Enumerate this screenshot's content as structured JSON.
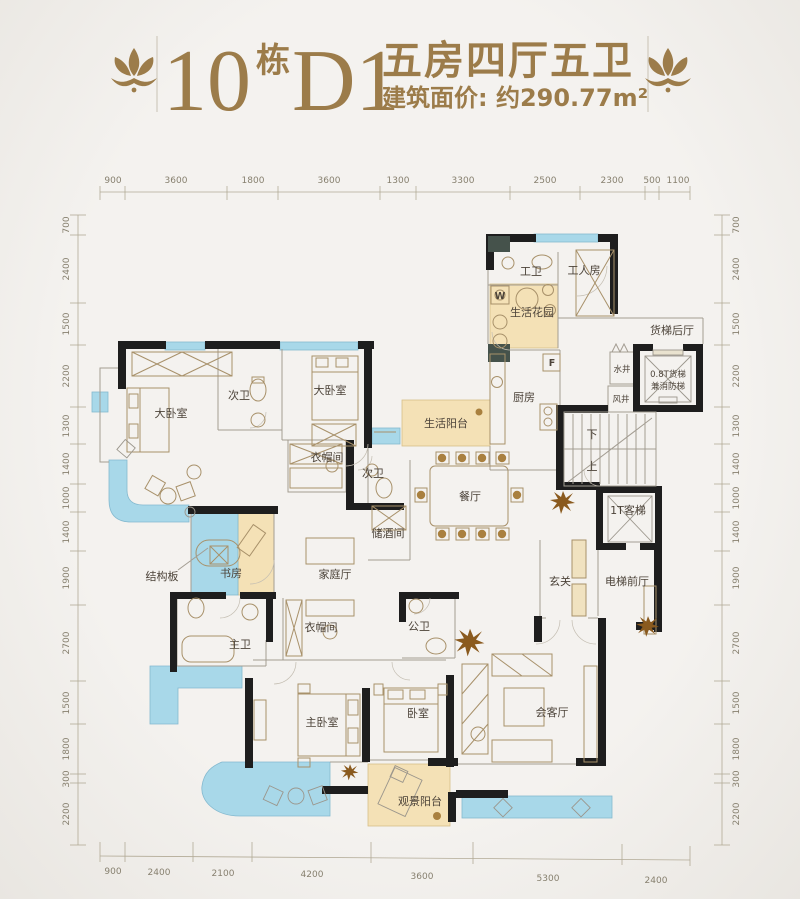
{
  "title": {
    "number": "10",
    "building_suffix": "栋",
    "model": "D1",
    "layout": "五房四厅五卫",
    "area_label": "建筑面价: 约290.77m²"
  },
  "dims": {
    "top": [
      "900",
      "3600",
      "1800",
      "3600",
      "1300",
      "3300",
      "2500",
      "2300",
      "500",
      "1100"
    ],
    "bottom": [
      "900",
      "2400",
      "2100",
      "4200",
      "3600",
      "5300",
      "2400"
    ],
    "left": [
      "700",
      "2400",
      "1500",
      "2200",
      "1300",
      "1400",
      "1000",
      "1400",
      "1900",
      "2700",
      "1500",
      "1800",
      "300",
      "2200"
    ],
    "right": [
      "700",
      "2400",
      "1500",
      "2200",
      "1300",
      "1400",
      "1000",
      "1400",
      "1900",
      "2700",
      "1500",
      "1800",
      "300",
      "2200"
    ]
  },
  "rooms": {
    "gong_wei": "工卫",
    "gongrenfang": "工人房",
    "shenghuo_huayuan": "生活花园",
    "huoti_houting": "货梯后厅",
    "shuijing": "水井",
    "fengjing": "风井",
    "huoti_line1": "0.8T货梯",
    "huoti_line2": "兼消防梯",
    "chufang": "厨房",
    "shenghuo_yangtai": "生活阳台",
    "xia": "下",
    "shang": "上",
    "keti": "1T客梯",
    "dianti_qianting": "电梯前厅",
    "xuanguan": "玄关",
    "canting": "餐厅",
    "chujiujian": "储酒间",
    "jiating_ting": "家庭厅",
    "da_woshi_1": "大卧室",
    "ci_wei_1": "次卫",
    "da_woshi_2": "大卧室",
    "yimaojian_1": "衣帽间",
    "ci_wei_2": "次卫",
    "shufang": "书房",
    "jiegouban": "结构板",
    "zhu_wei": "主卫",
    "yimaojian_2": "衣帽间",
    "gong_wei_2": "公卫",
    "zhu_woshi": "主卧室",
    "woshi": "卧室",
    "huiketing": "会客厅",
    "guanjing_yangtai": "观景阳台",
    "washer": "W",
    "fridge": "F"
  },
  "colors": {
    "accent_gold": "#9c7c4a",
    "wall": "#1e1e1e",
    "water_blue": "#a8d8e9",
    "balcony_tan": "#f4e1b6",
    "plant_brown": "#8a5a1e"
  }
}
